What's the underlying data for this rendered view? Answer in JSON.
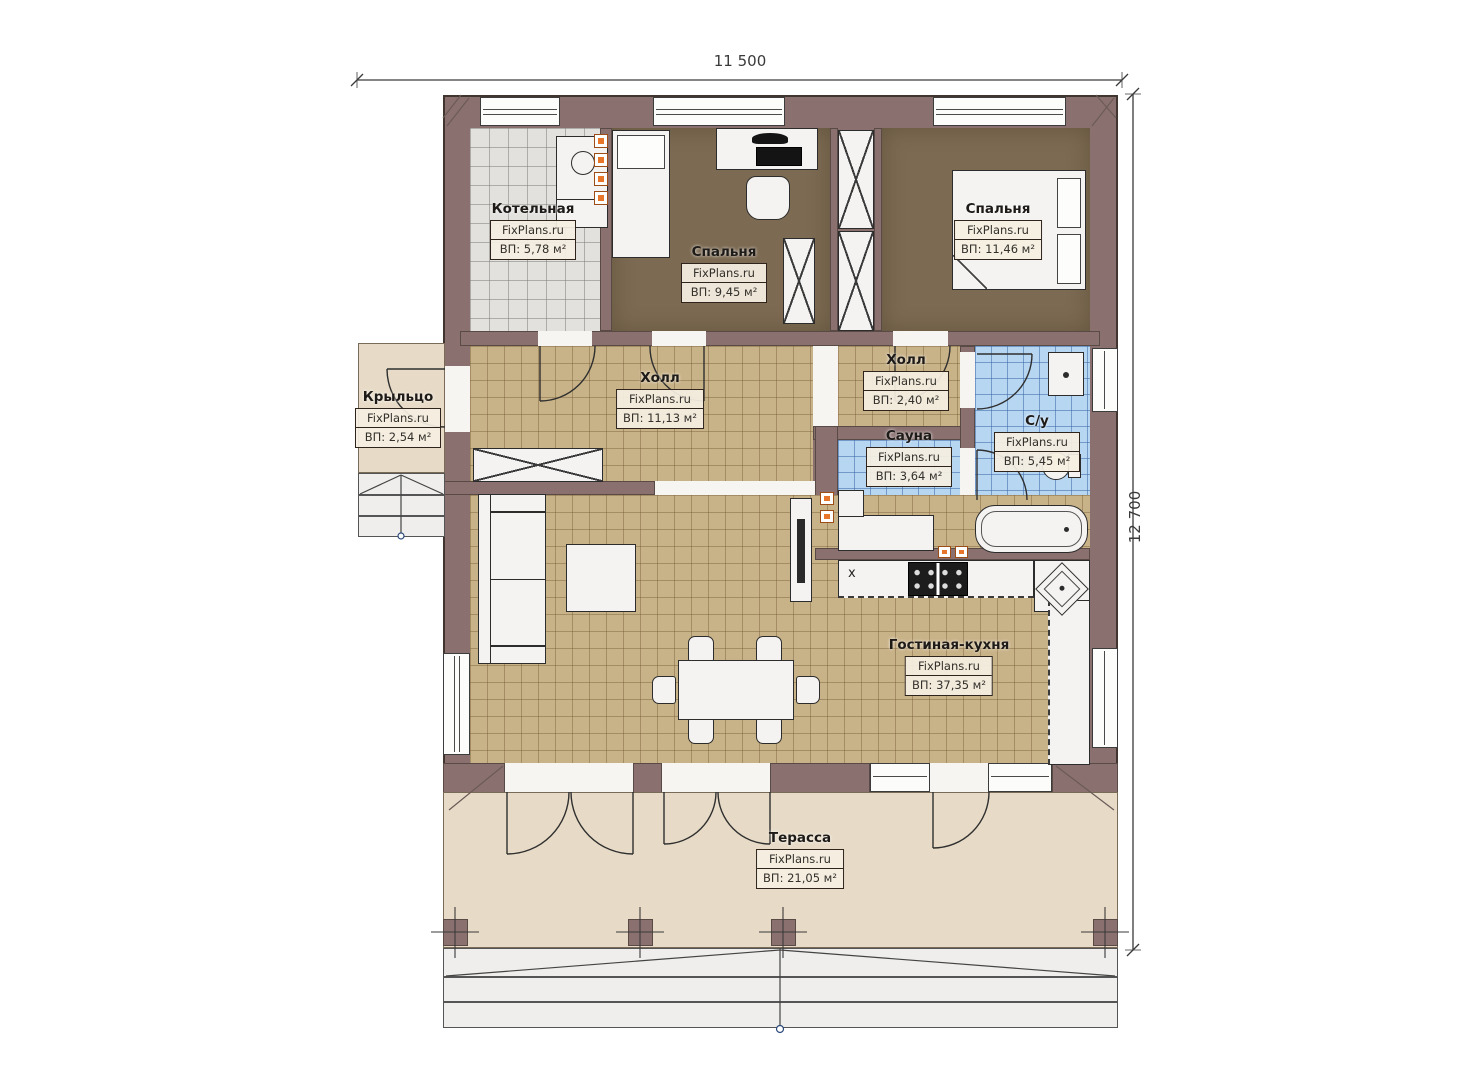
{
  "dims": {
    "width_label": "11 500",
    "height_label": "12 700"
  },
  "rooms": [
    {
      "key": "kotelnaya",
      "name": "Котельная",
      "brand": "FixPlans.ru",
      "area": "ВП: 5,78 м²"
    },
    {
      "key": "spalnya1",
      "name": "Спальня",
      "brand": "FixPlans.ru",
      "area": "ВП: 9,45 м²"
    },
    {
      "key": "spalnya2",
      "name": "Спальня",
      "brand": "FixPlans.ru",
      "area": "ВП: 11,46 м²"
    },
    {
      "key": "kryltso",
      "name": "Крыльцо",
      "brand": "FixPlans.ru",
      "area": "ВП: 2,54 м²"
    },
    {
      "key": "holl1",
      "name": "Холл",
      "brand": "FixPlans.ru",
      "area": "ВП: 11,13 м²"
    },
    {
      "key": "holl2",
      "name": "Холл",
      "brand": "FixPlans.ru",
      "area": "ВП: 2,40 м²"
    },
    {
      "key": "sauna",
      "name": "Сауна",
      "brand": "FixPlans.ru",
      "area": "ВП: 3,64 м²"
    },
    {
      "key": "su",
      "name": "С/у",
      "brand": "FixPlans.ru",
      "area": "ВП: 5,45 м²"
    },
    {
      "key": "gostinaya",
      "name": "Гостиная-кухня",
      "brand": "FixPlans.ru",
      "area": "ВП: 37,35 м²"
    },
    {
      "key": "terrassa",
      "name": "Терасса",
      "brand": "FixPlans.ru",
      "area": "ВП: 21,05 м²"
    }
  ],
  "markers": {
    "kitchen_cross": "x"
  },
  "colors": {
    "wall": "#8a7170",
    "tan_tile": "#c8b288",
    "blue_tile": "#b7d6f2",
    "grey_tile": "#e2e1de",
    "wood_floor": "#7c6a52",
    "terrace": "#e7dbc7",
    "accent_orange": "#e8762a"
  }
}
